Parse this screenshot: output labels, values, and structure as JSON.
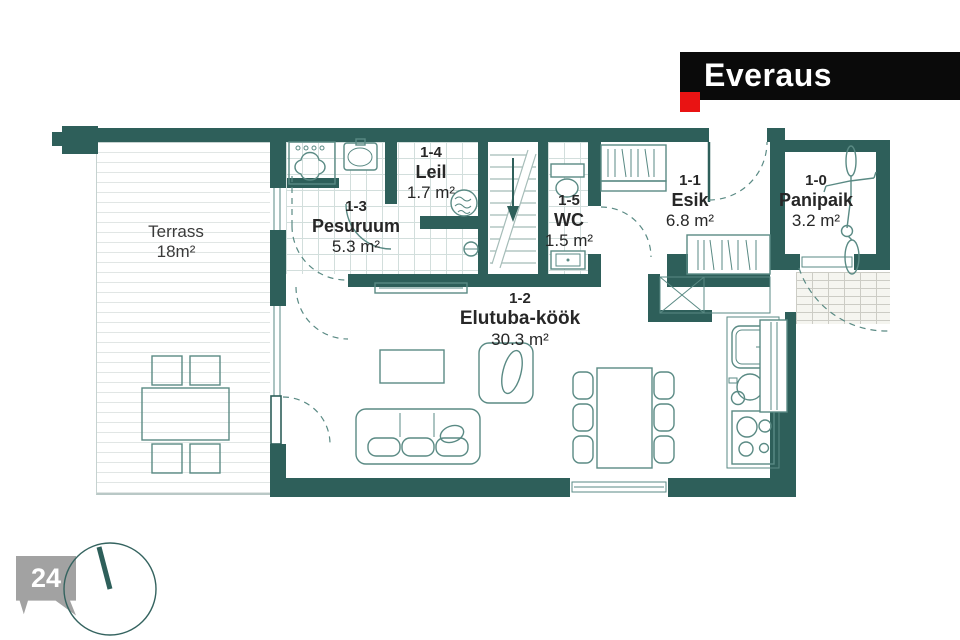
{
  "logo": {
    "brand": "Everaus"
  },
  "page_badge": {
    "number": "24"
  },
  "rooms": {
    "terrass": {
      "name": "Terrass",
      "area": "18m²"
    },
    "pesuruum": {
      "code": "1-3",
      "name": "Pesuruum",
      "area": "5.3 m²"
    },
    "leil": {
      "code": "1-4",
      "name": "Leil",
      "area": "1.7 m²"
    },
    "wc": {
      "code": "1-5",
      "name": "WC",
      "area": "1.5 m²"
    },
    "esik": {
      "code": "1-1",
      "name": "Esik",
      "area": "6.8 m²"
    },
    "panipaik": {
      "code": "1-0",
      "name": "Panipaik",
      "area": "3.2 m²"
    },
    "elutuba_kook": {
      "code": "1-2",
      "name": "Elutuba-köök",
      "area": "30.3 m²"
    }
  },
  "colors": {
    "wall": "#2e5f5a",
    "fline": "#5a8a84",
    "tile": "#d2dedc",
    "logo_bg": "#0a0a0a",
    "logo_accent": "#e91313",
    "badge_bg": "#a2a2a2"
  }
}
